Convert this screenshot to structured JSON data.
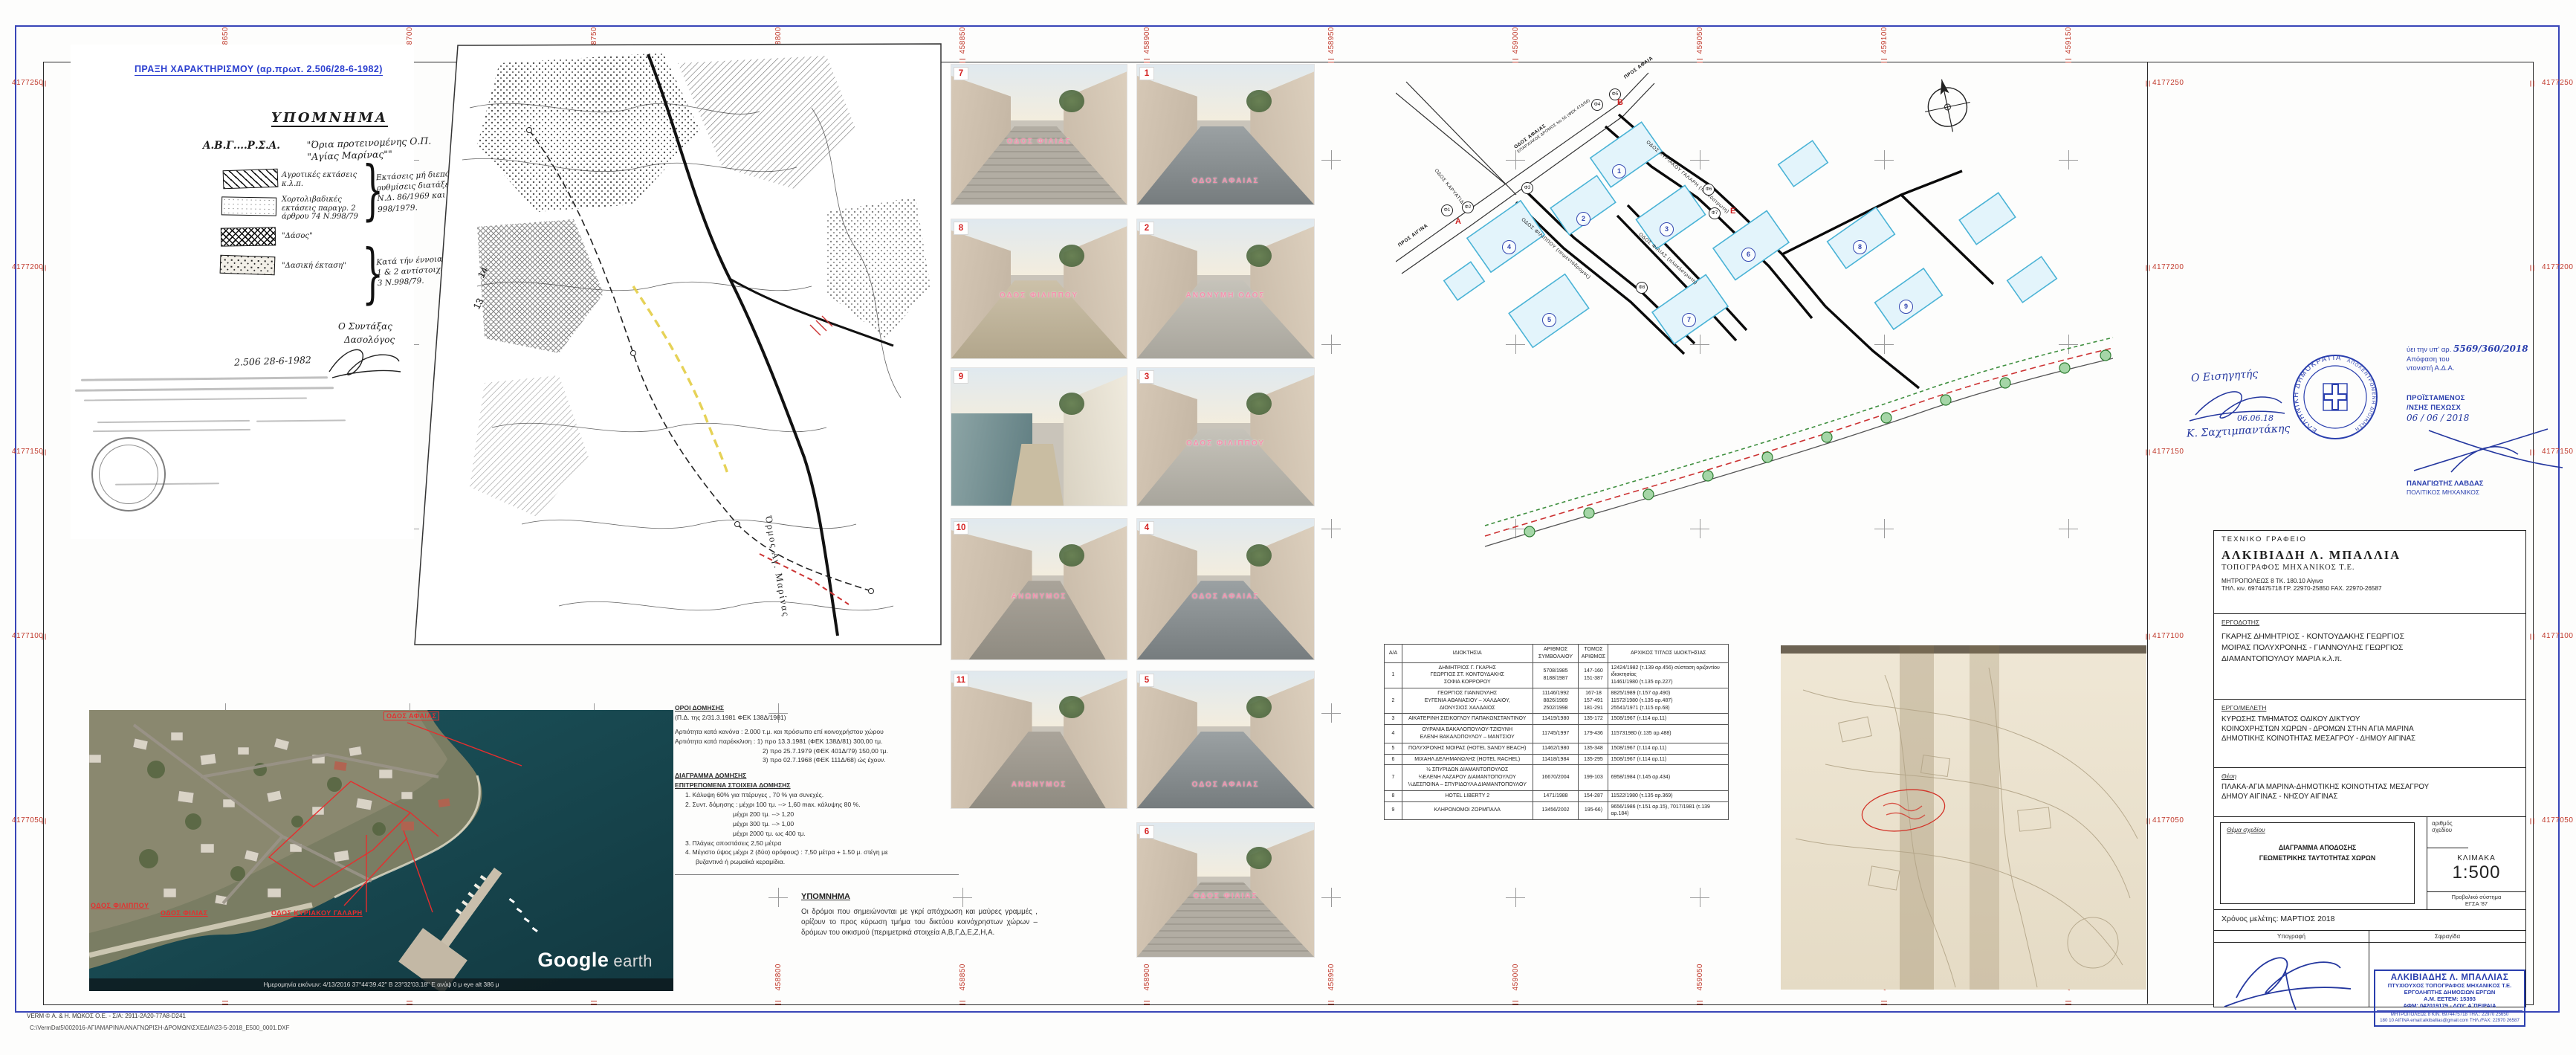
{
  "sheet": {
    "praxi_header": "ΠΡΑΞΗ  ΧΑΡΑΚΤΗΡΙΣΜΟΥ  (αρ.πρωτ. 2.506/28-6-1982)",
    "footer_license": "VERM  ©  Α.  & Η.  ΜΩΚΟΣ  Ο.Ε. - Σ/Α: 2911-2Α20-77Α8-D241",
    "footer_path": "C:\\VermDat5\\002016-ΑΓΙΑΜΑΡΙΝΑ\\ΑΝΑΓΝΩΡΙΣΗ-ΔΡΟΜΩΝ\\ΣΧΕΔΙΑ\\23-5-2018_E500_0001.DXF",
    "grid": {
      "eastings": [
        "458650",
        "458700",
        "458750",
        "458800",
        "458850",
        "458900",
        "458950",
        "459000",
        "459050",
        "459100",
        "459150"
      ],
      "northings": [
        "4177250",
        "4177200",
        "4177150",
        "4177100",
        "4177050"
      ],
      "color": "#c0392b"
    }
  },
  "forest_doc": {
    "title": "ΥΠΟΜΝΗΜΑ",
    "boundary_code": "Α.Β.Γ....Ρ.Σ.Α.",
    "boundary_desc": "\"Όρια προτεινομένης Ο.Π. \"Αγίας Μαρίνας\"\"",
    "legend": [
      {
        "label": "Αγροτικές εκτάσεις κ.λ.π.",
        "pattern": "diagonal-hatch"
      },
      {
        "label": "Χορτολιβαδικές εκτάσεις παραγρ. 2 άρθρου 74 Ν.998/79",
        "pattern": "dots"
      },
      {
        "label": "\"Δάσος\"",
        "pattern": "crosshatch"
      },
      {
        "label": "\"Δασική έκταση\"",
        "pattern": "stipple"
      }
    ],
    "note1": "Εκτάσεις μή διεπόμενες από ρυθμίσεις διατάξεων του Ν.Δ. 86/1969 και Ν. 998/1979.",
    "note2": "Κατά τήν έννοια τών παραγρ. 1 & 2 αντίστοιχα του άρθρου 3 Ν.998/79.",
    "signer_line1": "Ο Συντάξας",
    "signer_line2": "Δασολόγος",
    "date_line": "2.506   28-6-1982"
  },
  "survey_map": {
    "bay_label": "Όρμος Αγ. Μαρίνας",
    "numbers": [
      "14",
      "13"
    ]
  },
  "photos": [
    {
      "num": "1",
      "label": "ΟΔΟΣ  ΑΦΑΙΑΣ",
      "scene": "asphalt",
      "label_pos": "bottom"
    },
    {
      "num": "2",
      "label": "ΑΝΩΝΥΜΗ ΟΔΟΣ",
      "scene": "concrete",
      "label_pos": "mid"
    },
    {
      "num": "3",
      "label": "ΟΔΟΣ  ΦΙΛΙΠΠΟΥ",
      "scene": "concrete",
      "label_pos": "mid"
    },
    {
      "num": "4",
      "label": "ΟΔΟΣ  ΑΦΑΙΑΣ",
      "scene": "asphalt",
      "label_pos": "mid"
    },
    {
      "num": "5",
      "label": "ΟΔΟΣ ΑΦΑΙΑΣ",
      "scene": "asphalt",
      "label_pos": "bottom"
    },
    {
      "num": "6",
      "label": "ΟΔΟΣ ΦΙΛΙΑΣ",
      "scene": "paver",
      "label_pos": "mid"
    },
    {
      "num": "7",
      "label": "ΟΔΟΣ ΦΙΛΙΑΣ",
      "scene": "paver",
      "label_pos": "mid"
    },
    {
      "num": "8",
      "label": "ΟΔΟΣ ΦΙΛΙΠΠΟΥ",
      "scene": "dirt",
      "label_pos": "mid"
    },
    {
      "num": "9",
      "label": "",
      "scene": "coast",
      "label_pos": "mid"
    },
    {
      "num": "10",
      "label": "ΑΝΩΝΥΜΟΣ",
      "scene": "alley",
      "label_pos": "mid"
    },
    {
      "num": "11",
      "label": "ΑΝΩΝΥΜΟΣ",
      "scene": "alley",
      "label_pos": "bottom"
    }
  ],
  "photos_note": {
    "title": "ΥΠΟΜΝΗΜΑ",
    "body": "Οι δρόμοι που σημειώνονται με γκρί απόχρωση και μαύρες γραμμές , ορίζουν το προς κύρωση τμήμα του δικτύου κοινόχρηστων χώρων – δρόμων του οικισμού (περιμετρικά στοιχεία Α,Β,Γ,Δ,Ε,Ζ,Η,Α."
  },
  "building_terms": {
    "h1": "ΟΡΟΙ ΔΟΜΗΣΗΣ",
    "l1": "(Π.Δ. της 2/31.3.1981 ΦΕΚ 138Δ/1981)",
    "l2": "Αρτιότητα  κατά κανόνα : 2.000 τ.μ. και πρόσωπο επί κοινοχρήστου χώρου",
    "l3": "Αρτιότητα κατά παρέκκλιση : 1) προ 13.3.1981 (ΦΕΚ 138Δ/81) 300,00 τμ.",
    "l4": "2) προ 25.7.1979 (ΦΕΚ 401Δ/79) 150,00 τμ.",
    "l5": "3) προ 02.7.1968 (ΦΕΚ 111Δ/68)  ώς έχουν.",
    "h2": "ΔΙΑΓΡΑΜΜΑ ΔΟΜΗΣΗΣ",
    "h3": "ΕΠΙΤΡΕΠΟΜΕΝΑ ΣΤΟΙΧΕΙΑ ΔΟΜΗΣΗΣ",
    "e1": "1.  Κάλυψη 60% για πτέρυγες , 70 %  για συνεχές.",
    "e2": "2.  Συντ. δόμησης : μέχρι 100 τμ. --> 1,60 max. κάλυψης 80 %.",
    "e3": "μέχρι 200 τμ. --> 1,20",
    "e4": "μέχρι 300 τμ. --> 1,00",
    "e5": "μέχρι 2000 τμ. ως 400 τμ.",
    "e6": "3.  Πλάγιες αποστάσεις  2,50 μέτρα",
    "e7": "4.  Μέγιστο ύψος  μέχρι 2 (δύο) ορόφους)  : 7,50 μέτρα + 1.50 μ. στέγη με",
    "e8": "βυζαντινά ή ρωμαϊκά κεραμίδια."
  },
  "cad_plan": {
    "streets": {
      "afeas": "ΟΔΟΣ ΑΦΑΙΑΣ",
      "afeas_sub": "ΕΠΑΡΧΙΑΚΟΣ ΔΡΟΜΟΣ Νο 56 (ΦΕΚ 47Δ/56)",
      "galari": "ΟΔΟΣ ΚΥΡΙΑΚΟΥ ΓΑΛΑΡΗ (πλακόστρωτη)",
      "filippou": "ΟΔΟΣ ΦΙΛΙΠΠΟΥ (τσιμεντόδρομος)",
      "filias": "ΟΔΟΣ ΦΙΛΙΑΣ (πλακόστρωτη)",
      "karyatidon": "ΟΔΟΣ ΚΑΡΥΑΤΙΔΩΝ",
      "pros_aigina": "ΠΡΟΣ ΑΙΓΙΝΑ",
      "pros_afaia": "ΠΡΟΣ ΑΦΑΙΑ"
    },
    "vertex_letters": [
      "Α",
      "Β",
      "Ε"
    ],
    "phi_points": [
      "Φ1",
      "Φ2",
      "Φ3",
      "Φ4",
      "Φ5",
      "Φ6",
      "Φ7",
      "Φ8"
    ],
    "parcel_numbers": [
      "1",
      "2",
      "3",
      "4",
      "5",
      "6",
      "7",
      "8",
      "9"
    ]
  },
  "own_table": {
    "headers": [
      "Α/Α",
      "ΙΔΙΟΚΤΗΣΙΑ",
      "ΑΡΙΘΜΟΣ ΣΥΜΒΟΛΑΙΟΥ",
      "ΤΟΜΟΣ ΑΡΙΘΜΟΣ",
      "ΑΡΧΙΚΟΣ ΤΙΤΛΟΣ  ΙΔΙΟΚΤΗΣΙΑΣ"
    ],
    "rows": [
      {
        "aa": "1",
        "owner": "ΔΗΜΗΤΡΙΟΣ Γ. ΓΚΑΡΗΣ\nΓΕΩΡΓΙΟΣ ΣΤ. ΚΟΝΤΟΥΔΑΚΗΣ\nΣΟΦΙΑ ΚΟΡΡΟΡΟΥ",
        "contract": "5708/1985\n8188/1987",
        "tome": "147-160\n151-387",
        "title": "12424/1982 (τ.139 αρ.456) σύσταση οριζοντίου ιδιοκτησίας\n11461/1980 (τ.135 αρ.227)"
      },
      {
        "aa": "2",
        "owner": "ΓΕΩΡΓΙΟΣ  ΓΙΑΝΝΟΥΛΗΣ\nΕΥΓΕΝΙΑ ΑΘΑΝΑΣΙΟΥ – ΧΑΛΔΑΙΟΥ,\nΔΙΟΝΥΣΙΟΣ  ΧΑΛΔΑΙΟΣ",
        "contract": "11146/1992\n8826/1989\n2502/1998",
        "tome": "167-18\n157-491\n181-291",
        "title": "8825/1989 (τ.157 αρ.490)\n11572/1980 (τ.135 αρ.487)\n25541/1971 (τ.115 αρ.68)"
      },
      {
        "aa": "3",
        "owner": "ΑΙΚΑΤΕΡΙΝΗ ΣΙΣΙΚΟΓΛΟΥ ΠΑΠΑΚΩΝΣΤΑΝΤΙΝΟΥ",
        "contract": "11419/1980",
        "tome": "135-172",
        "title": "1508/1967 (τ.114 αρ.11)"
      },
      {
        "aa": "4",
        "owner": "ΟΥΡΑΝΙΑ ΒΑΚΑΛΟΠΟΥΛΟΥ-ΤΖΙΟΥΝΗ\nΕΛΕΝΗ ΒΑΚΑΛΟΠΟΥΛΟΥ – ΜΑΝΤΣΙΟΥ",
        "contract": "11745/1997",
        "tome": "179-436",
        "title": "115731980 (τ.135 αρ.488)"
      },
      {
        "aa": "5",
        "owner": "ΠΟΛΥΧΡΟΝΗΣ ΜΟΙΡΑΣ (HOTEL SANDY BEACH)",
        "contract": "11462/1980",
        "tome": "135-348",
        "title": "1508/1967 (τ.114 αρ.11)"
      },
      {
        "aa": "6",
        "owner": "ΜΙΧΑΗΛ ΔΕΛΗΜΑΝΩΛΗΣ (HOTEL RACHEL)",
        "contract": "11418/1984",
        "tome": "135-295",
        "title": "1508/1967 (τ.114 αρ.11)"
      },
      {
        "aa": "7",
        "owner": "½ ΣΠΥΡΙΔΩΝ ΔΙΑΜΑΝΤΟΠΟΥΛΟΣ\n¼ΕΛΕΝΗ ΛΑΖΑΡΟΥ ΔΙΑΜΑΝΤΟΠΟΥΛΟΥ\n¼ΔΕΣΠΟΙΝΑ – ΣΠΥΡΙΔΟΥΛΑ ΔΙΑΜΑΝΤΟΠΟΥΛΟΥ",
        "contract": "16670/2004",
        "tome": "199-103",
        "title": "6958/1984 (τ.145 αρ.434)"
      },
      {
        "aa": "8",
        "owner": "HOTEL LIBERTY 2",
        "contract": "1471/1988",
        "tome": "154-287",
        "title": "11522/1980 (τ.135 αρ.369)"
      },
      {
        "aa": "9",
        "owner": "ΚΛΗΡΟΝΟΜΟΙ ΖΟΡΜΠΑΛΑ",
        "contract": "13456/2002",
        "tome": "195-66)",
        "title": "9656/1986 (τ.151 αρ.15), 7017/1981 (τ.139 αρ.184)"
      }
    ]
  },
  "satellite": {
    "labels": {
      "afeas": "ΟΔΟΣ ΑΦΑΙΑΣ",
      "filippou": "ΟΔΟΣ ΦΙΛΙΠΠΟΥ",
      "filias": "ΟΔΟΣ ΦΙΛΙΑΣ",
      "galari": "ΟΔΟΣ ΚΥΡΙΑΚΟΥ ΓΑΛΑΡΗ"
    },
    "google": "Google",
    "earth": "earth",
    "status": "Ημερομηνία εικόνων: 4/13/2016     37°44'39.42\" Β   23°32'03.18\" Ε ανύψ     0 μ    eye alt    386 μ"
  },
  "stamps": {
    "reviewer_title": "Ο  Εισηγητής",
    "reviewer_date": "06.06.18",
    "reviewer_name": "Κ. Σαχτιμπαντάκης",
    "seal_ring1": "ΕΛΛΗΝΙΚΗ ΔΗΜΟΚΡΑΤΙΑ",
    "seal_ring2": "ΑΠΟΚΕΝΤΡΩΜΕΝΗ ΔΙΟΙΚΗΣΗ",
    "approval_l1": "ύει την υπ' αρ.",
    "approval_num": "5569/360/2018",
    "approval_l2": "Απόφαση  του",
    "approval_l3": "ντονιστή  Α.Δ.Α.",
    "approval_h1": "ΠΡΟΪΣΤΑΜΕΝΟΣ",
    "approval_h2": "/ΝΣΗΣ  ΠΕΧΩΣΧ",
    "approval_date": "06 / 06 / 2018",
    "approval_name": "ΠΑΝΑΓΙΩΤΗΣ ΛΑΒΔΑΣ",
    "approval_role": "ΠΟΛΙΤΙΚΟΣ ΜΗΧΑΝΙΚΟΣ"
  },
  "title_block": {
    "office_label": "ΤΕΧΝΙΚΟ   ΓΡΑΦΕΙΟ",
    "office_name": "ΑΛΚΙΒΙΑΔΗ   Λ.   ΜΠΑΛΛΙΑ",
    "office_role": "ΤΟΠΟΓΡΑΦΟΣ  ΜΗΧΑΝΙΚΟΣ  Τ.Ε.",
    "office_addr": "ΜΗΤΡΟΠΟΛΕΩΣ 8   ΤΚ. 180.10 Αίγινα",
    "office_tel": "ΤΗΛ. κιν. 6974475718  ΓΡ. 22970-25850 FAX. 22970-26587",
    "employer_label": "ΕΡΓΟΔΟΤΗΣ",
    "employer_lines": [
      "ΓΚΑΡΗΣ ΔΗΜΗΤΡΙΟΣ - ΚΟΝΤΟΥΔΑΚΗΣ ΓΕΩΡΓΙΟΣ",
      "ΜΟΙΡΑΣ ΠΟΛΥΧΡΟΝΗΣ - ΓΙΑΝΝΟΥΛΗΣ ΓΕΩΡΓΙΟΣ",
      "ΔΙΑΜΑΝΤΟΠΟΥΛΟΥ ΜΑΡΙΑ  κ.λ.π."
    ],
    "project_label": "ΕΡΓΟ/ΜΕΛΕΤΗ",
    "project_lines": [
      "ΚΥΡΩΣΗΣ ΤΜΗΜΑΤΟΣ ΟΔΙΚΟΥ ΔΙΚΤΥΟΥ",
      "ΚΟΙΝΟΧΡΗΣΤΩΝ ΧΩΡΩΝ - ΔΡΟΜΩΝ ΣΤΗΝ ΑΓΙΑ ΜΑΡΙΝΑ",
      "ΔΗΜΟΤΙΚΗΣ ΚΟΙΝΟΤΗΤΑΣ ΜΕΣΑΓΡΟΥ - ΔΗΜΟΥ ΑΙΓΙΝΑΣ"
    ],
    "location_label": "Θέση",
    "location_lines": [
      "ΠΛΑΚΑ-ΑΓΙΑ ΜΑΡΙΝΑ-ΔΗΜΟΤΙΚΗΣ ΚΟΙΝΟΤΗΤΑΣ ΜΕΣΑΓΡΟΥ",
      "ΔΗΜΟΥ ΑΙΓΙΝΑΣ - ΝΗΣΟΥ  ΑΙΓΙΝΑΣ"
    ],
    "subject_label": "Θέμα σχεδίου",
    "subject_line1": "ΔΙΑΓΡΑΜΜΑ ΑΠΟΔΟΣΗΣ",
    "subject_line2": "ΓΕΩΜΕΤΡΙΚΗΣ ΤΑΥΤΟΤΗΤΑΣ ΧΩΡΩΝ",
    "number_label1": "αριθμός",
    "number_label2": "σχεδίου",
    "scale_label": "ΚΛΙΜΑΚΑ",
    "scale_value": "1:500",
    "proj_label": "Προβολικό σύστημα",
    "proj_value": "ΕΓΣΑ '87",
    "time_label": "Χρόνος μελέτης:   ΜΑΡΤΙΟΣ  2018",
    "sig_label": "Υπογραφή",
    "stamp_label": "Σφραγίδα",
    "stamp_l1": "ΑΛΚΙΒΙΑΔΗΣ Λ. ΜΠΑΛΛΙΑΣ",
    "stamp_l2": "ΠΤΥΧΙΟΥΧΟΣ ΤΟΠΟΓΡΑΦΟΣ ΜΗΧΑΝΙΚΟΣ Τ.Ε.",
    "stamp_l3": "ΕΡΓΟΛΗΠΤΗΣ ΔΗΜΟΣΙΩΝ ΕΡΓΩΝ",
    "stamp_l4": "Α.Μ. ΕΕΤΕΜ: 15393",
    "stamp_l5": "ΑΦΜ: 042019179 - ΔΟΥ: Α΄ΠΕΙΡΑΙΑ",
    "stamp_l6": "ΜΗΤΡΟΠΟΛΕΩΣ 8    ΚΙΝ. 6974475718    ΤΗΛ.: 22970 25650",
    "stamp_l7": "180 10 ΑΙΓΙΝΑ   email:alkiballias@gmail.com   ΤΗΛ./FAX: 22970 26587"
  }
}
